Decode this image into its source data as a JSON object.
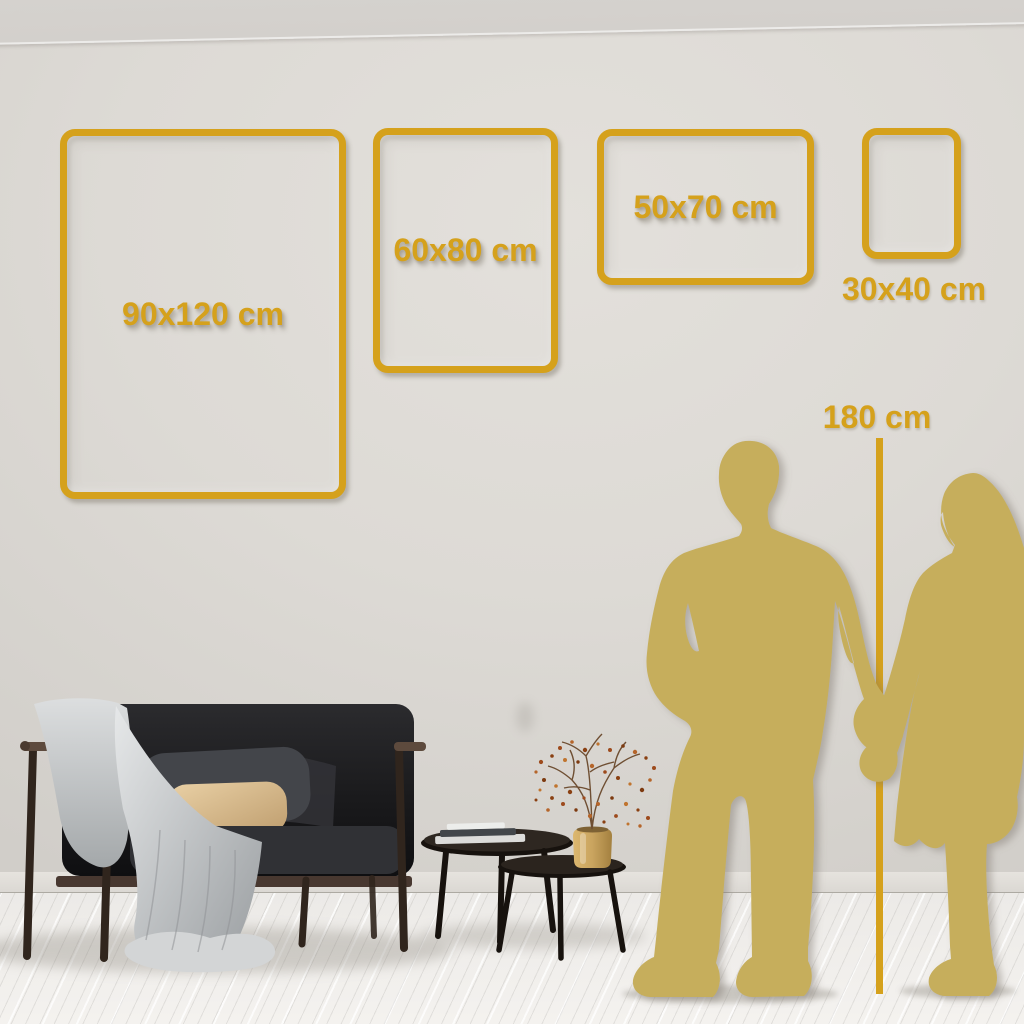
{
  "size_guide": {
    "frames": [
      {
        "id": "90x120",
        "label": "90x120 cm"
      },
      {
        "id": "60x80",
        "label": "60x80 cm"
      },
      {
        "id": "50x70",
        "label": "50x70 cm"
      },
      {
        "id": "30x40",
        "label": "30x40 cm"
      }
    ],
    "height_marker": {
      "label": "180 cm"
    }
  },
  "colors": {
    "accent_gold": "#D5A11C",
    "silhouette_gold": "#C6AE5C",
    "wall": "#DDDAD5",
    "floor": "#F0EEEB"
  }
}
